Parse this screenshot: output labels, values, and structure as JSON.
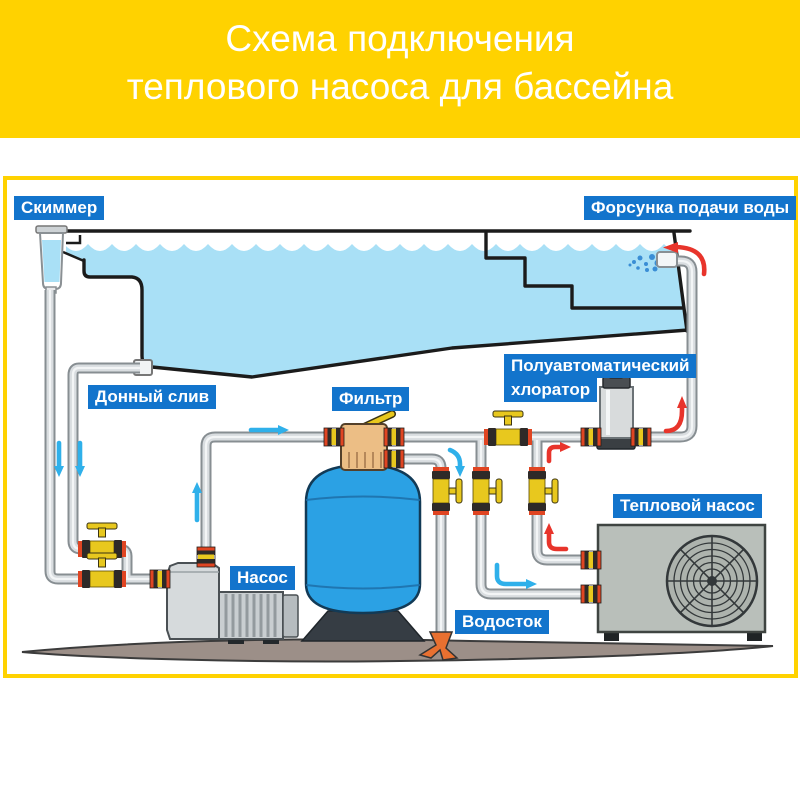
{
  "header": {
    "title_line1": "Схема подключения",
    "title_line2": "теплового насоса для бассейна"
  },
  "diagram": {
    "labels": {
      "skimmer": "Скиммер",
      "water_nozzle": "Форсунка подачи воды",
      "bottom_drain": "Донный слив",
      "filter": "Фильтр",
      "chlorinator_line1": "Полуавтоматический",
      "chlorinator_line2": "хлоратор",
      "pump": "Насос",
      "heat_pump": "Тепловой насос",
      "drain": "Водосток"
    }
  },
  "colors": {
    "header_bg": "#ffd200",
    "border": "#ffd200",
    "label_bg": "#1274cc",
    "label_text": "#ffffff",
    "water": "#a9e0f6",
    "tank_blue": "#2ba1e4",
    "flow_cold": "#2fb0ea",
    "flow_hot": "#e8342b",
    "pipe_fill": "#d9dde0",
    "pipe_edge": "#878e92",
    "valve_yellow": "#e8c81e",
    "valve_red": "#e04522",
    "valve_dark": "#2e2a28",
    "multiport_tan": "#ecbe85",
    "equipment_gray": "#c9ced1",
    "heatpump_gray": "#b9bfba",
    "ground": "#9c8f88",
    "funnel_orange": "#e87030"
  }
}
